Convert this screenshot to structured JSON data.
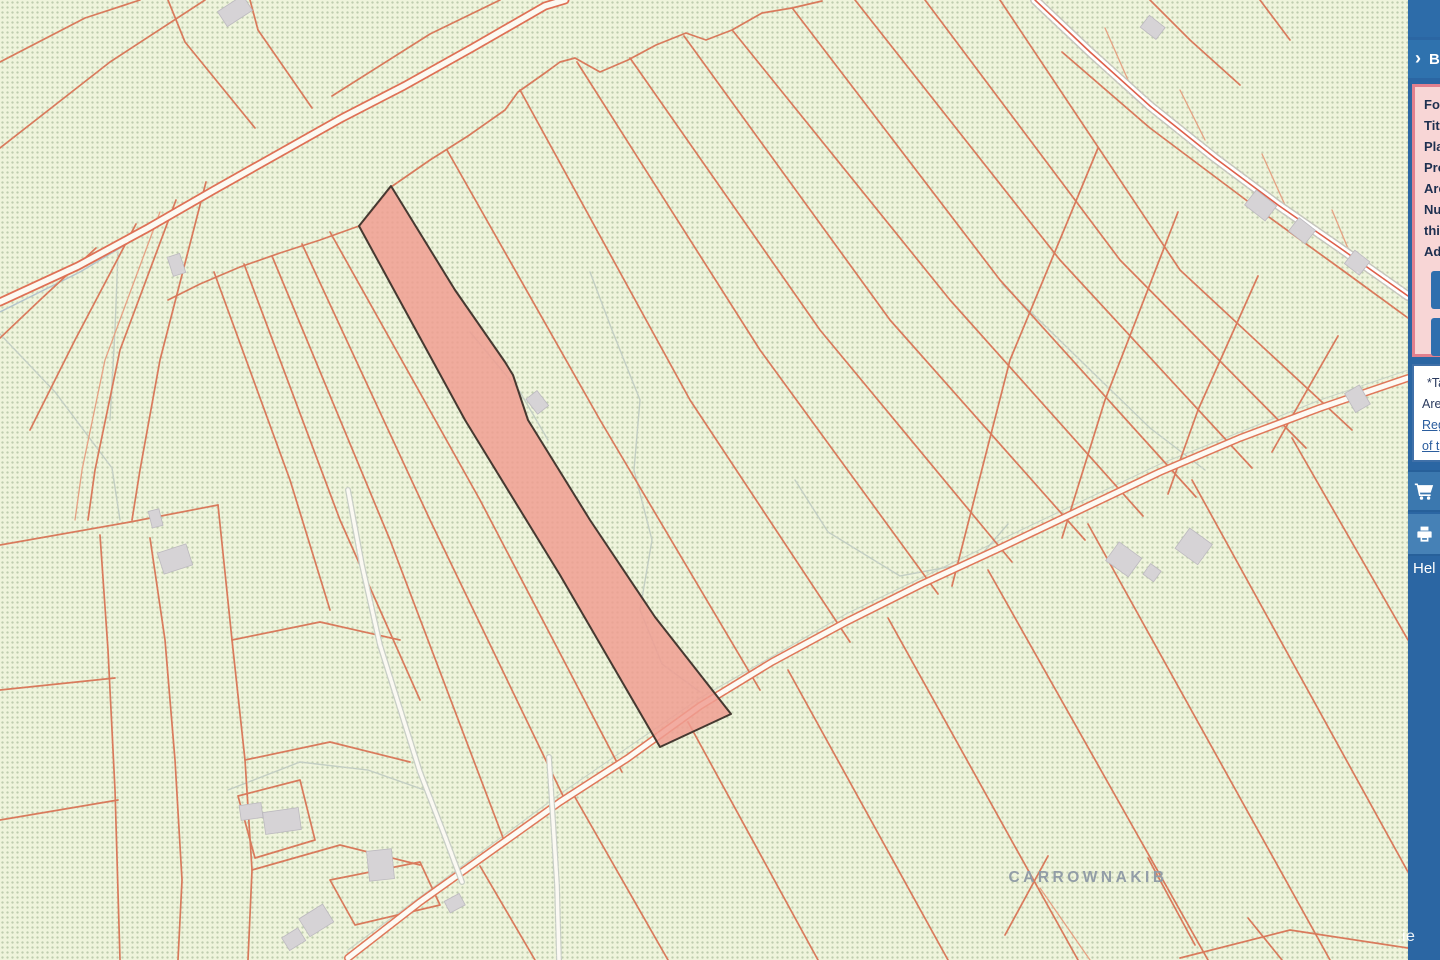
{
  "map": {
    "townland_label": "CARROWNAKIB",
    "watermark": ".ie",
    "colors": {
      "map_background": "#eff4dc",
      "parcel_line": "#d97a5c",
      "parcel_line_light": "#e6a183",
      "field_path_gray": "#c3cec3",
      "road_fill": "#fdfaf4",
      "road_casing": "#e0775a",
      "building_fill": "#d6d3d6",
      "highlight_fill": "#f09e92",
      "highlight_outline": "#463931",
      "townland_label_color": "#929da7"
    }
  },
  "sidebar": {
    "colors": {
      "base_blue": "#2b66a3",
      "row_blue": "#2f72ae",
      "panel_pink_bg": "#f8d6d6",
      "panel_pink_border": "#e2808e",
      "button_blue": "#2f6fae",
      "note_border_blue": "#4070a8"
    },
    "menu_icon": "hamburger-icon",
    "toggle": {
      "icon": "chevron-right-icon",
      "label": "B"
    },
    "info_panel": {
      "lines": [
        "Fol",
        "Titl",
        "Pla",
        "Pro",
        "Are",
        "Nu",
        "this",
        "Add"
      ],
      "buttons": [
        {
          "label": "H"
        },
        {
          "label": ""
        }
      ]
    },
    "note_panel": {
      "text_lines": [
        "*Ta",
        "Area"
      ],
      "link_lines": [
        "Reg",
        "of t"
      ]
    },
    "menu_items": [
      {
        "icon": "cart-icon",
        "label": ""
      },
      {
        "icon": "printer-icon",
        "label": ""
      },
      {
        "icon": "",
        "label": "Hel"
      }
    ]
  }
}
